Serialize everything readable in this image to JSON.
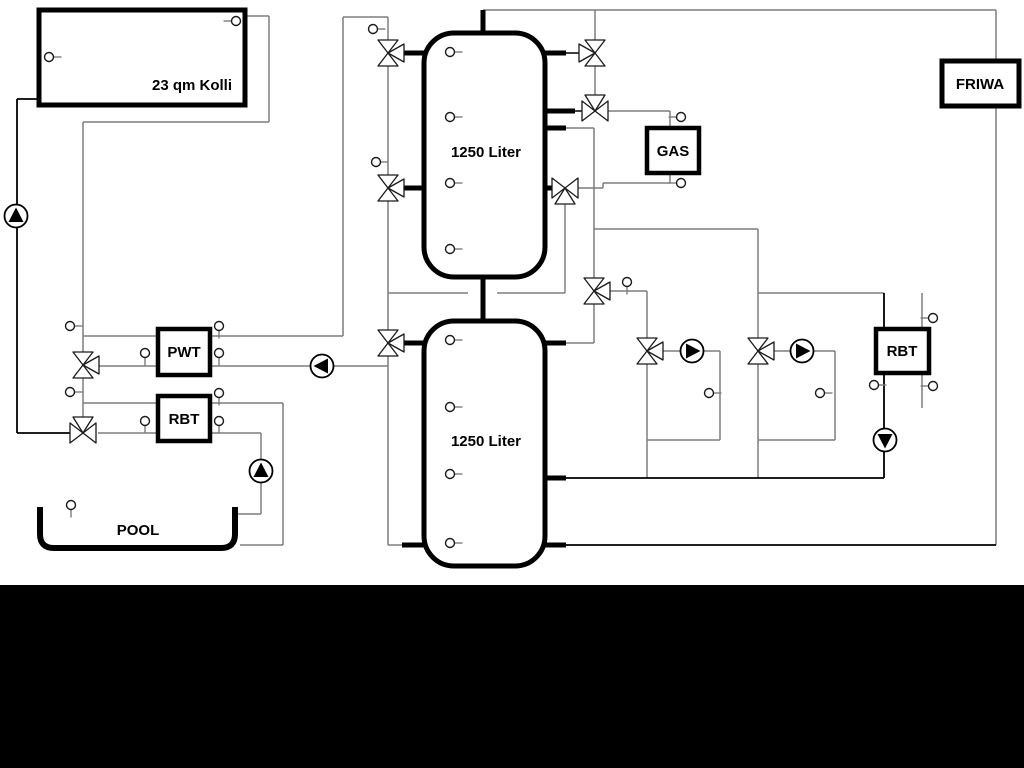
{
  "diagram": {
    "labels": {
      "collector": "23 qm Kolli",
      "tank_upper": "1250 Liter",
      "tank_lower": "1250 Liter",
      "pwt": "PWT",
      "rbt_left": "RBT",
      "rbt_right": "RBT",
      "gas": "GAS",
      "friwa": "FRIWA",
      "pool": "POOL"
    },
    "symbols": {
      "pump": "circle-with-filled-triangle",
      "valve": "bowtie-triangles",
      "sensor": "small-circle-with-stem"
    },
    "colors": {
      "pipe_gray": "#7d7d7d",
      "line_black": "#000000",
      "background": "#ffffff",
      "footer": "#000000"
    }
  }
}
